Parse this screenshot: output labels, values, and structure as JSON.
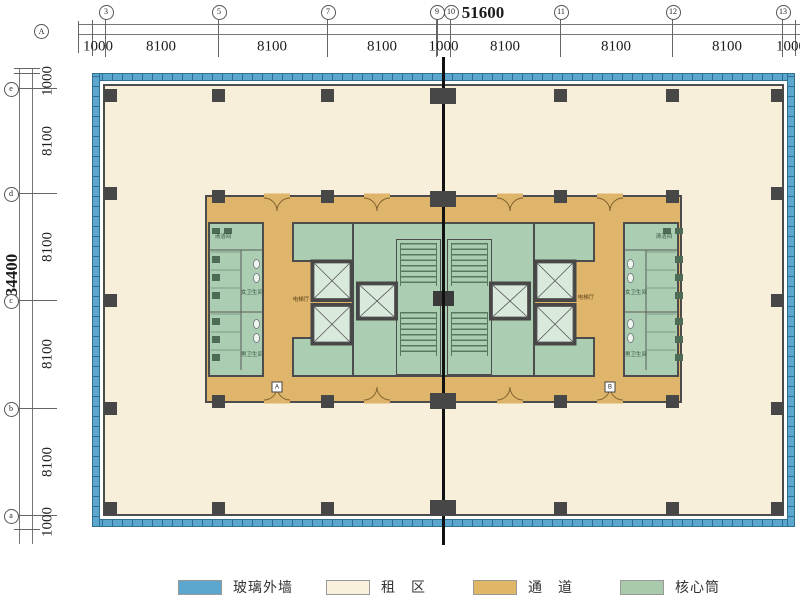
{
  "drawing": {
    "corner_axis_label": "A",
    "detail_markers": [
      "A",
      "B"
    ]
  },
  "grid": {
    "top_bubbles": [
      "3",
      "5",
      "7",
      "9",
      "10",
      "11",
      "12",
      "13"
    ],
    "left_bubbles": [
      "e",
      "d",
      "c",
      "b",
      "a"
    ]
  },
  "dimensions": {
    "top": {
      "total": "51600",
      "segments": [
        "1000",
        "8100",
        "8100",
        "8100",
        "1000",
        "8100",
        "8100",
        "8100",
        "1000"
      ]
    },
    "left": {
      "total": "34400",
      "segments": [
        "1000",
        "8100",
        "8100",
        "8100",
        "8100",
        "1000"
      ]
    }
  },
  "rooms": {
    "elevator_hall": "电梯厅",
    "womens_toilet": "女卫生间",
    "mens_toilet": "男卫生间",
    "cleaning_room": "清洁间"
  },
  "legend": {
    "items": [
      {
        "label": "玻璃外墙",
        "color": "#5ba7ce"
      },
      {
        "label": "租　区",
        "color": "#faf1dd"
      },
      {
        "label": "通　道",
        "color": "#e0b667"
      },
      {
        "label": "核心筒",
        "color": "#a9cbab"
      }
    ]
  },
  "colors": {
    "glass_wall": "#5ba7ce",
    "rental_area": "#f8efdb",
    "corridor": "#dfb46b",
    "core": "#abceb2",
    "wall": "#4c4c4c",
    "section_line": "#111111"
  }
}
